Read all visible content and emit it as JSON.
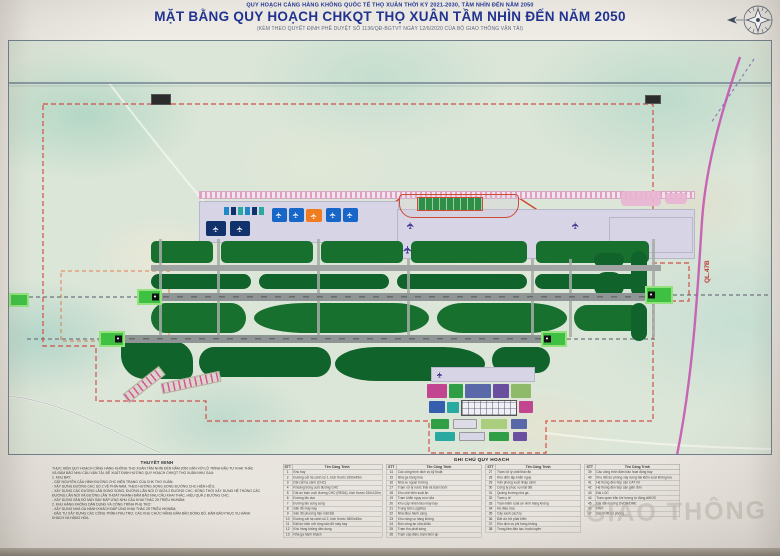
{
  "header": {
    "line1": "QUY HOẠCH CẢNG HÀNG KHÔNG QUỐC TẾ THỌ XUÂN THỜI KỲ 2021-2030, TẦM NHÌN ĐẾN NĂM 2050",
    "line2": "MẶT BẰNG QUY HOẠCH CHKQT THỌ XUÂN TẦM NHÌN ĐẾN NĂM 2050",
    "line3": "(KÈM THEO QUYẾT ĐỊNH PHÊ DUYỆT SỐ 1136/QĐ-BGTVT NGÀY 12/6/2020 CỦA BỘ GIAO THÔNG VẬN TẢI)"
  },
  "map": {
    "road_label": "QL.47B"
  },
  "notes": {
    "heading": "THUYẾT MINH",
    "lines": [
      "THỰC HIỆN QUY HOẠCH CẢNG HÀNG KHÔNG THỌ XUÂN TẦM NHÌN ĐẾN NĂM 2050 GẮN VỚI LỘ TRÌNH ĐẦU TƯ KHAI THÁC",
      "VÀ ĐẢM BẢO NHU CẦU VẬN TẢI, ĐỀ XUẤT ĐỊNH HƯỚNG QUY HOẠCH CHKQT THỌ XUÂN NHƯ SAU:",
      "1. KHU BAY:",
      "- GIỮ NGUYÊN CẤU HÌNH ĐƯỜNG CHC HIỆN TRẠNG CỦA CHK THỌ XUÂN;",
      "- XÂY DỰNG ĐƯỜNG CHC SỐ 2 VỀ PHÍA NAM, THEO HƯỚNG SONG SONG ĐƯỜNG CHC HIỆN HỮU;",
      "- XÂY DỰNG CÁC ĐƯỜNG LĂN SONG SONG, ĐƯỜNG LĂN NỐI Ở GIỮA 2 ĐƯỜNG CHC, ĐỒNG THỜI XÂY DỰNG HỆ THỐNG CÁC",
      "ĐƯỜNG LĂN NỐI VÀ ĐƯỜNG LĂN THOÁT NHANH ĐẢM BẢO NHU CẦU KHAI THÁC, HIỆU QUẢ 2 ĐƯỜNG CHC;",
      "- XÂY DỰNG SÂN ĐỖ MÁY BAY ĐÁP ỨNG NHU CẦU KHAI THÁC 25 TRIỆU HK/NĂM;",
      "2. KHU HÀNG KHÔNG DÂN DỤNG VÀ CÔNG TRÌNH PHỤ TRỢ:",
      "- XÂY DỰNG NHÀ GA HÀNH KHÁCH ĐÁP ỨNG KHAI THÁC 25 TRIỆU HK/NĂM;",
      "- ĐẦU TƯ XÂY DỰNG CÁC CÔNG TRÌNH PHỤ TRỢ, CÁC KHU CHỨC NĂNG ĐẢM BẢO ĐỒNG BỘ, ĐẢM BẢO PHỤC VỤ HÀNH",
      "KHÁCH VÀ HÀNG HÓA."
    ]
  },
  "legend": {
    "title": "GHI CHÚ QUY HOẠCH",
    "col_no": "STT",
    "col_name": "Tên Công Trình",
    "groups": [
      {
        "rows": [
          {
            "no": "1",
            "name": "Khu bay"
          },
          {
            "no": "2",
            "name": "Đường cất hạ cánh số 1, kích thước 3200x45m"
          },
          {
            "no": "3",
            "name": "Dải cất hạ cánh (CHC)"
          },
          {
            "no": "4",
            "name": "Khoảng trống cuối đường CHC"
          },
          {
            "no": "5",
            "name": "Dải an toàn cuối đường CHC (RESA), kích thước 240x120m"
          },
          {
            "no": "6",
            "name": "Đường lăn dọc"
          },
          {
            "no": "7",
            "name": "Đường lăn song song"
          },
          {
            "no": "8",
            "name": "Sân đỗ máy bay"
          },
          {
            "no": "9",
            "name": "Sân đỗ phương tiện mặt đất"
          },
          {
            "no": "10",
            "name": "Đường cất hạ cánh số 2, kích thước 3800x45m"
          },
          {
            "no": "11",
            "name": "Đất dự kiến mở rộng sân đỗ máy bay"
          },
          {
            "no": "12",
            "name": "Khu hàng không dân dụng"
          },
          {
            "no": "13",
            "name": "Nhà ga hành khách"
          }
        ]
      },
      {
        "rows": [
          {
            "no": "14",
            "name": "Các công trình dịch vụ kỹ thuật"
          },
          {
            "no": "15",
            "name": "Nhà ga hàng hóa"
          },
          {
            "no": "16",
            "name": "Nhà xe ngoại trường"
          },
          {
            "no": "17",
            "name": "Trạm xử lý nước thải và trạm bơm"
          },
          {
            "no": "18",
            "name": "Khu chế biến suất ăn"
          },
          {
            "no": "19",
            "name": "Trạm khẩn nguy cứu hỏa"
          },
          {
            "no": "20",
            "name": "Khu cấp nhiên liệu máy bay"
          },
          {
            "no": "21",
            "name": "Trung tâm Logistics"
          },
          {
            "no": "22",
            "name": "Nhà điều hành cảng"
          },
          {
            "no": "23",
            "name": "Khu cảng vụ hàng không"
          },
          {
            "no": "24",
            "name": "Đồn công an cửa khẩu"
          },
          {
            "no": "25",
            "name": "Trạm thu phát sóng"
          },
          {
            "no": "26",
            "name": "Trạm cấp điện, trạm biến áp"
          }
        ]
      },
      {
        "rows": [
          {
            "no": "27",
            "name": "Trạm xử lý chất thải rắn"
          },
          {
            "no": "28",
            "name": "Khu diễn tập khẩn nguy"
          },
          {
            "no": "29",
            "name": "Văn phòng xuất nhập cảnh"
          },
          {
            "no": "30",
            "name": "Công ty phục vụ mặt đất"
          },
          {
            "no": "31",
            "name": "Quảng trường nhà ga"
          },
          {
            "no": "32",
            "name": "Trạm y tế"
          },
          {
            "no": "33",
            "name": "Trạm kiểm soát an ninh hàng không"
          },
          {
            "no": "34",
            "name": "Hồ điều hòa"
          },
          {
            "no": "35",
            "name": "Cây xanh cách ly"
          },
          {
            "no": "36",
            "name": "Đất dự trữ phát triển"
          },
          {
            "no": "37",
            "name": "Khu dịch vụ phi hàng không"
          },
          {
            "no": "38",
            "name": "Trung tâm đào tạo, huấn luyện"
          }
        ]
      },
      {
        "rows": [
          {
            "no": "39",
            "name": "Các công trình đảm bảo hoạt động bay"
          },
          {
            "no": "40",
            "name": "Khu đất dự phòng xây dựng đài kiểm soát không lưu"
          },
          {
            "no": "41",
            "name": "Hệ thống đèn tiếp cận CAT I/II"
          },
          {
            "no": "42",
            "name": "Hệ thống đèn tiếp cận giản đơn"
          },
          {
            "no": "43",
            "name": "Đài LOC"
          },
          {
            "no": "44",
            "name": "Trạm quan trắc khí tượng tự động AWOS"
          },
          {
            "no": "45",
            "name": "Đài dẫn hướng DVOR/DME"
          },
          {
            "no": "46",
            "name": "PAPI"
          },
          {
            "no": "47",
            "name": "Đài VOR dự phòng"
          }
        ]
      }
    ]
  },
  "watermark": "GIAO THÔNG",
  "icons": {
    "plane": "✈",
    "compass": "compass-rose"
  },
  "colors": {
    "title_blue": "#203390",
    "green1": "#17702e",
    "green2": "#10632a",
    "runway_gray": "#8f9494",
    "thr_green": "#3ec043",
    "stand_blue": "#1766c8",
    "stand_navy": "#10316b",
    "stand_orange": "#ef7d1f",
    "boundary_red": "#d2403a",
    "road_magenta": "#c44fae"
  }
}
